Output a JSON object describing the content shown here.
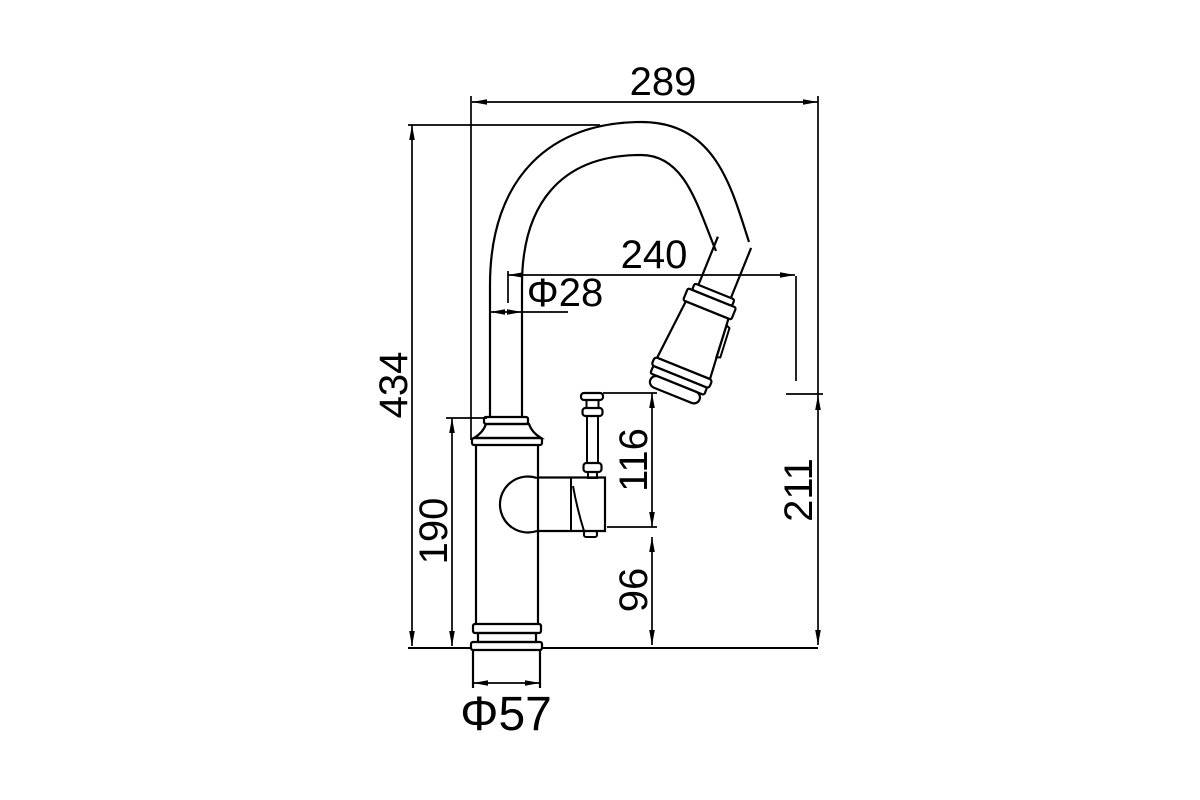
{
  "figure": {
    "type": "technical-drawing",
    "subject": "pull-down kitchen faucet side elevation",
    "background_color": "#ffffff",
    "line_color": "#000000"
  },
  "dimensions": {
    "overall_width": "289",
    "spout_reach": "240",
    "spout_diameter": "Φ28",
    "overall_height": "434",
    "body_height": "190",
    "handle_upper_height": "116",
    "handle_lower_height": "96",
    "outlet_height": "211",
    "base_diameter": "Φ57"
  }
}
